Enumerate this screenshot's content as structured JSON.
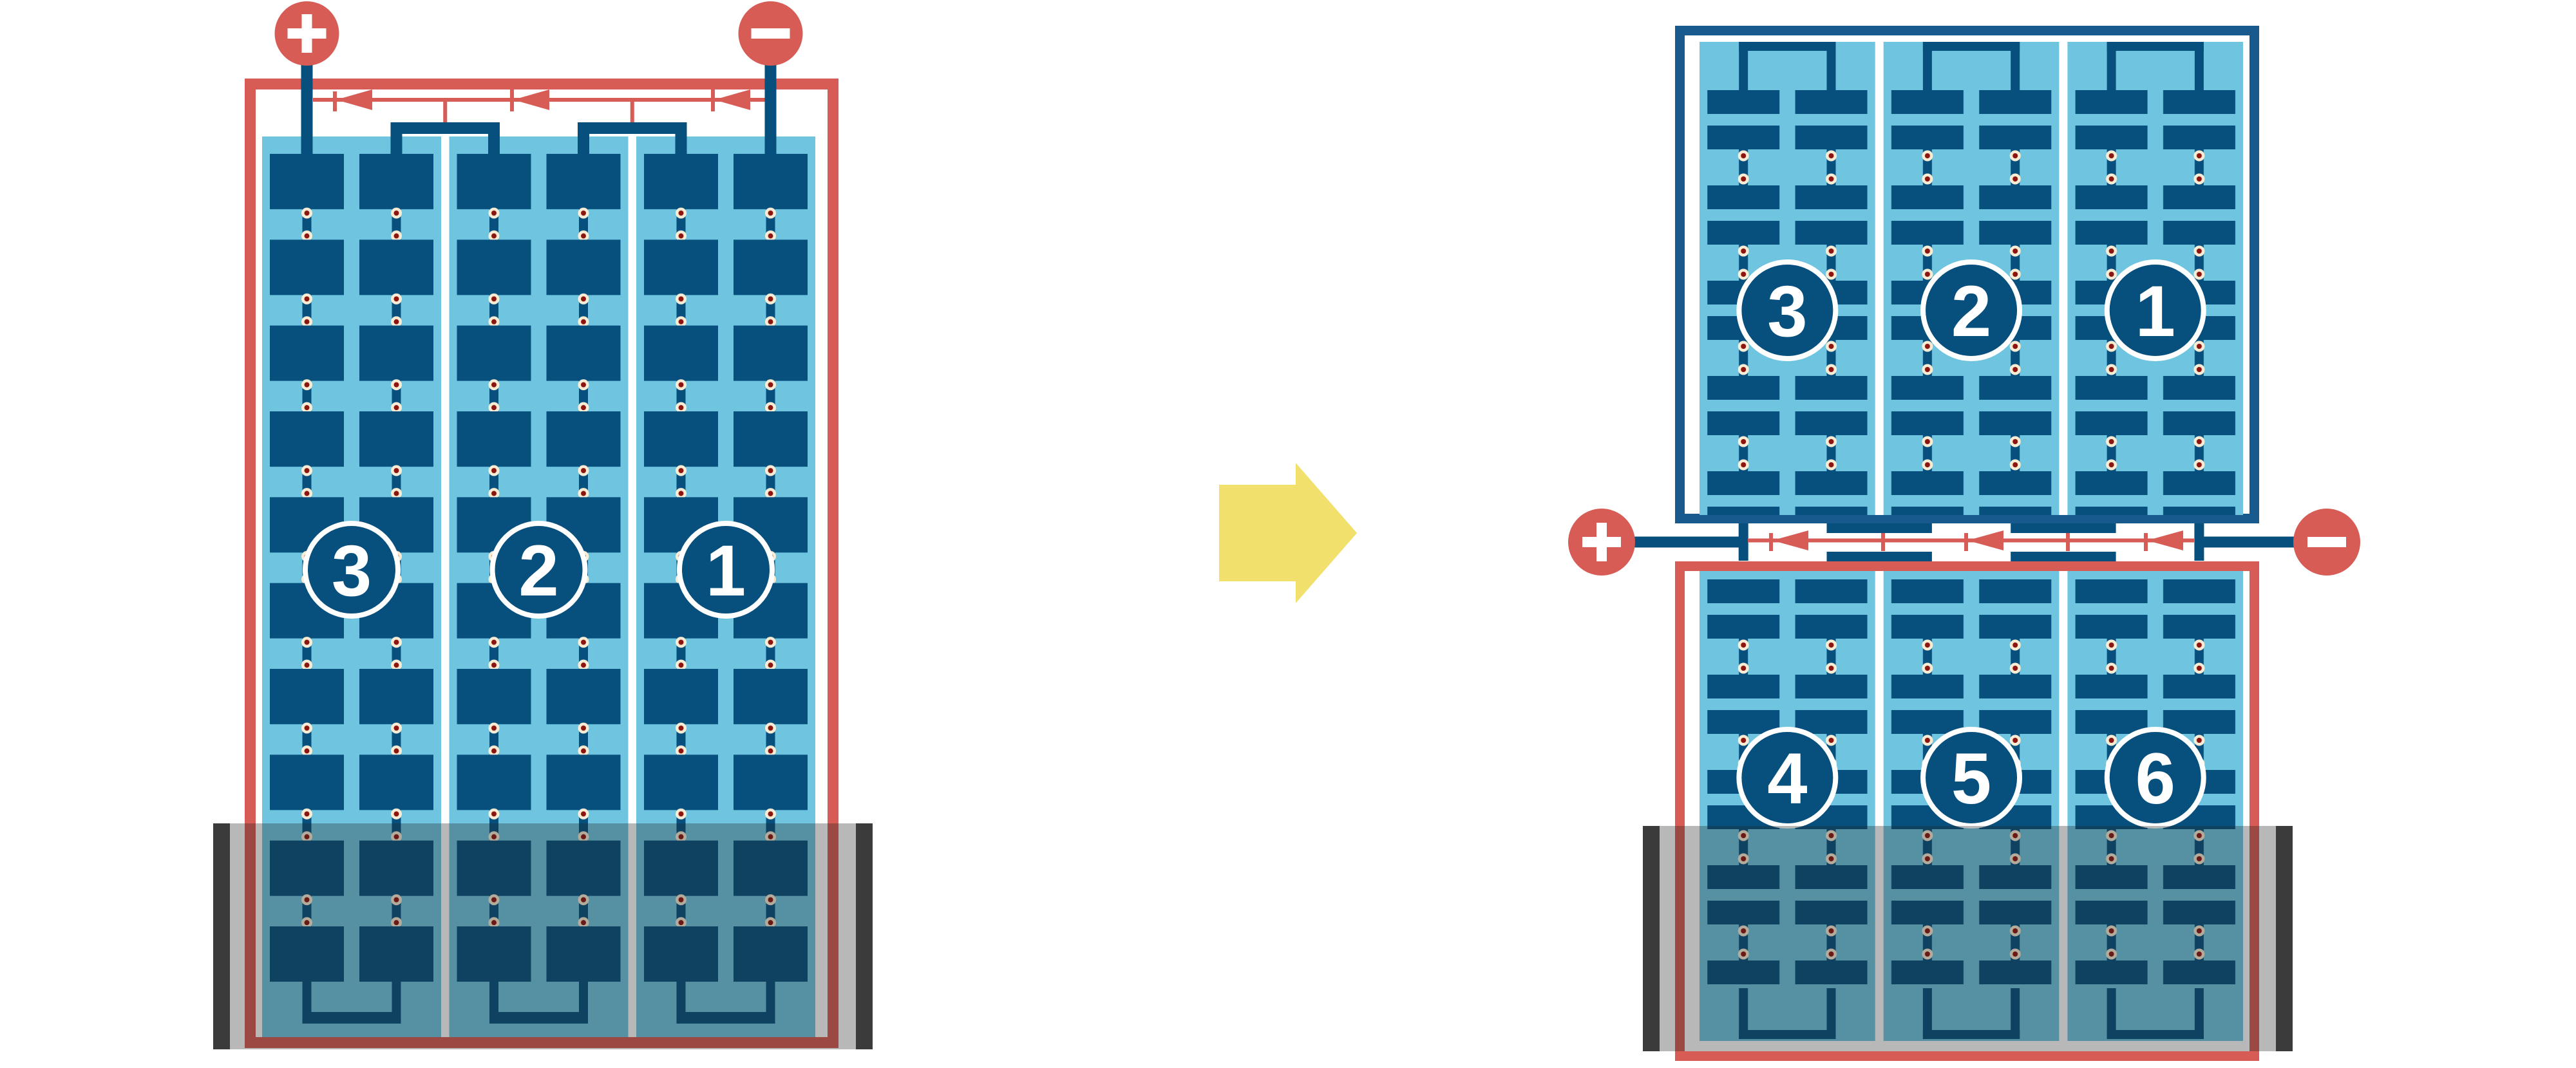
{
  "left_battery": {
    "terminals": {
      "positive": "+",
      "negative": "−"
    },
    "cells": [
      {
        "label": "3"
      },
      {
        "label": "2"
      },
      {
        "label": "1"
      }
    ]
  },
  "right_battery": {
    "terminals": {
      "positive": "+",
      "negative": "−"
    },
    "top_cells": [
      {
        "label": "3"
      },
      {
        "label": "2"
      },
      {
        "label": "1"
      }
    ],
    "bottom_cells": [
      {
        "label": "4"
      },
      {
        "label": "5"
      },
      {
        "label": "6"
      }
    ]
  },
  "colors": {
    "red": "#D65C55",
    "plate_navy": "#07507E",
    "case_blue": "#185A8D",
    "electrolyte_blue": "#6FC5E0",
    "rivet_cream": "#F8ECD4",
    "rivet_maroon": "#8C150F",
    "arrow_yellow": "#F2E06C",
    "flood_cap_grey": "#3B3B3B",
    "flood_overlay": "rgba(35,35,35,0.32)"
  }
}
